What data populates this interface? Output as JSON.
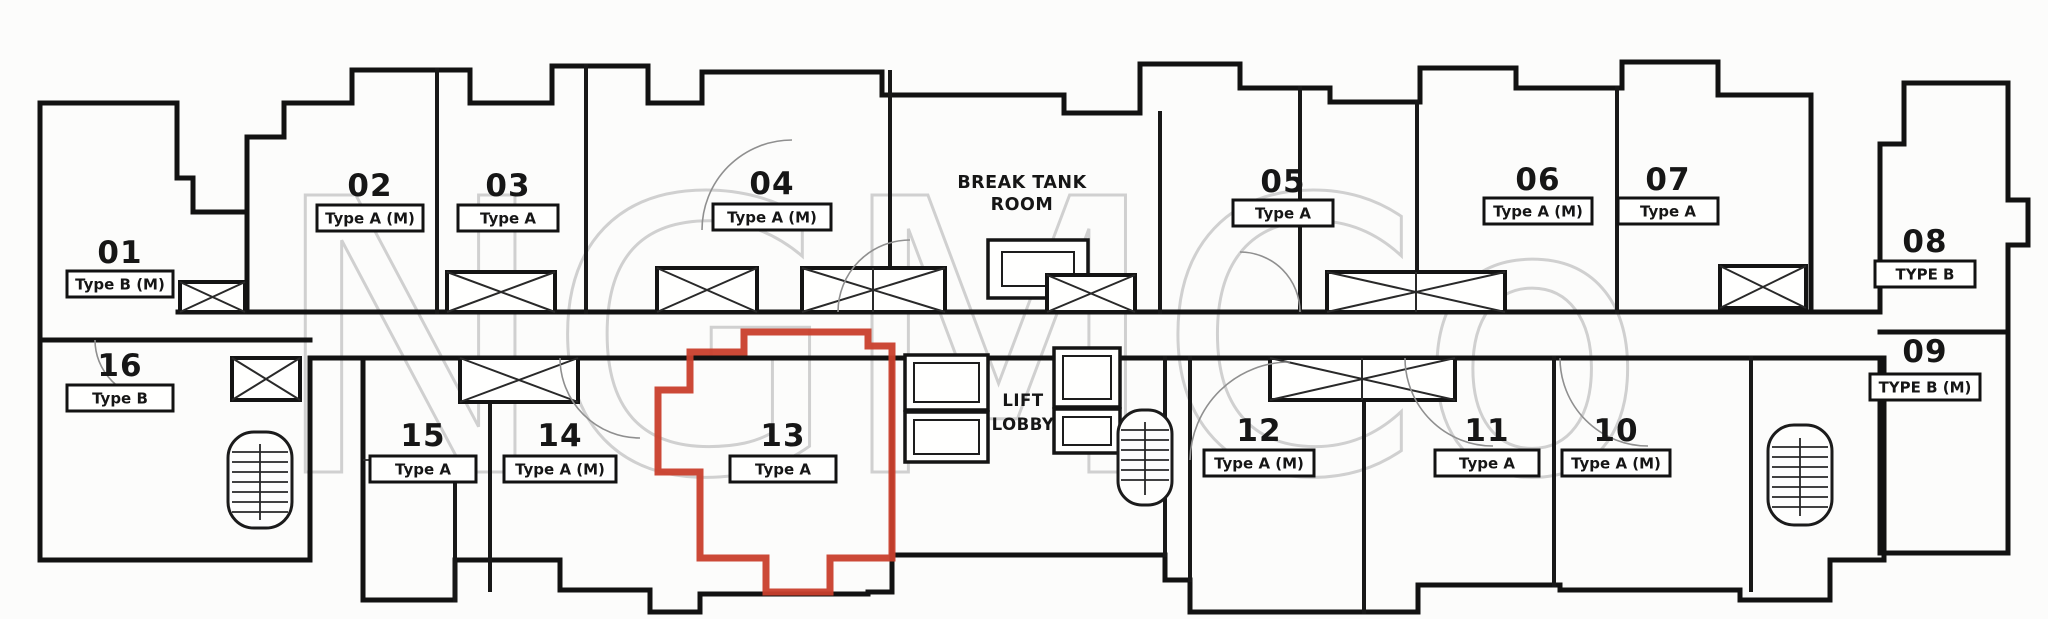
{
  "watermark": "NGMCo",
  "highlight_color": "#c8402e",
  "rooms": {
    "break_tank_line1": "BREAK TANK",
    "break_tank_line2": "ROOM",
    "lift_lobby_line1": "LIFT",
    "lift_lobby_line2": "LOBBY"
  },
  "units": [
    {
      "number": "01",
      "type": "Type B (M)"
    },
    {
      "number": "02",
      "type": "Type A (M)"
    },
    {
      "number": "03",
      "type": "Type A"
    },
    {
      "number": "04",
      "type": "Type A (M)"
    },
    {
      "number": "05",
      "type": "Type A"
    },
    {
      "number": "06",
      "type": "Type A (M)"
    },
    {
      "number": "07",
      "type": "Type A"
    },
    {
      "number": "08",
      "type": "TYPE B"
    },
    {
      "number": "09",
      "type": "TYPE B (M)"
    },
    {
      "number": "10",
      "type": "Type A (M)"
    },
    {
      "number": "11",
      "type": "Type A"
    },
    {
      "number": "12",
      "type": "Type A (M)"
    },
    {
      "number": "13",
      "type": "Type A",
      "highlighted": true
    },
    {
      "number": "14",
      "type": "Type A (M)"
    },
    {
      "number": "15",
      "type": "Type A"
    },
    {
      "number": "16",
      "type": "Type B"
    }
  ]
}
